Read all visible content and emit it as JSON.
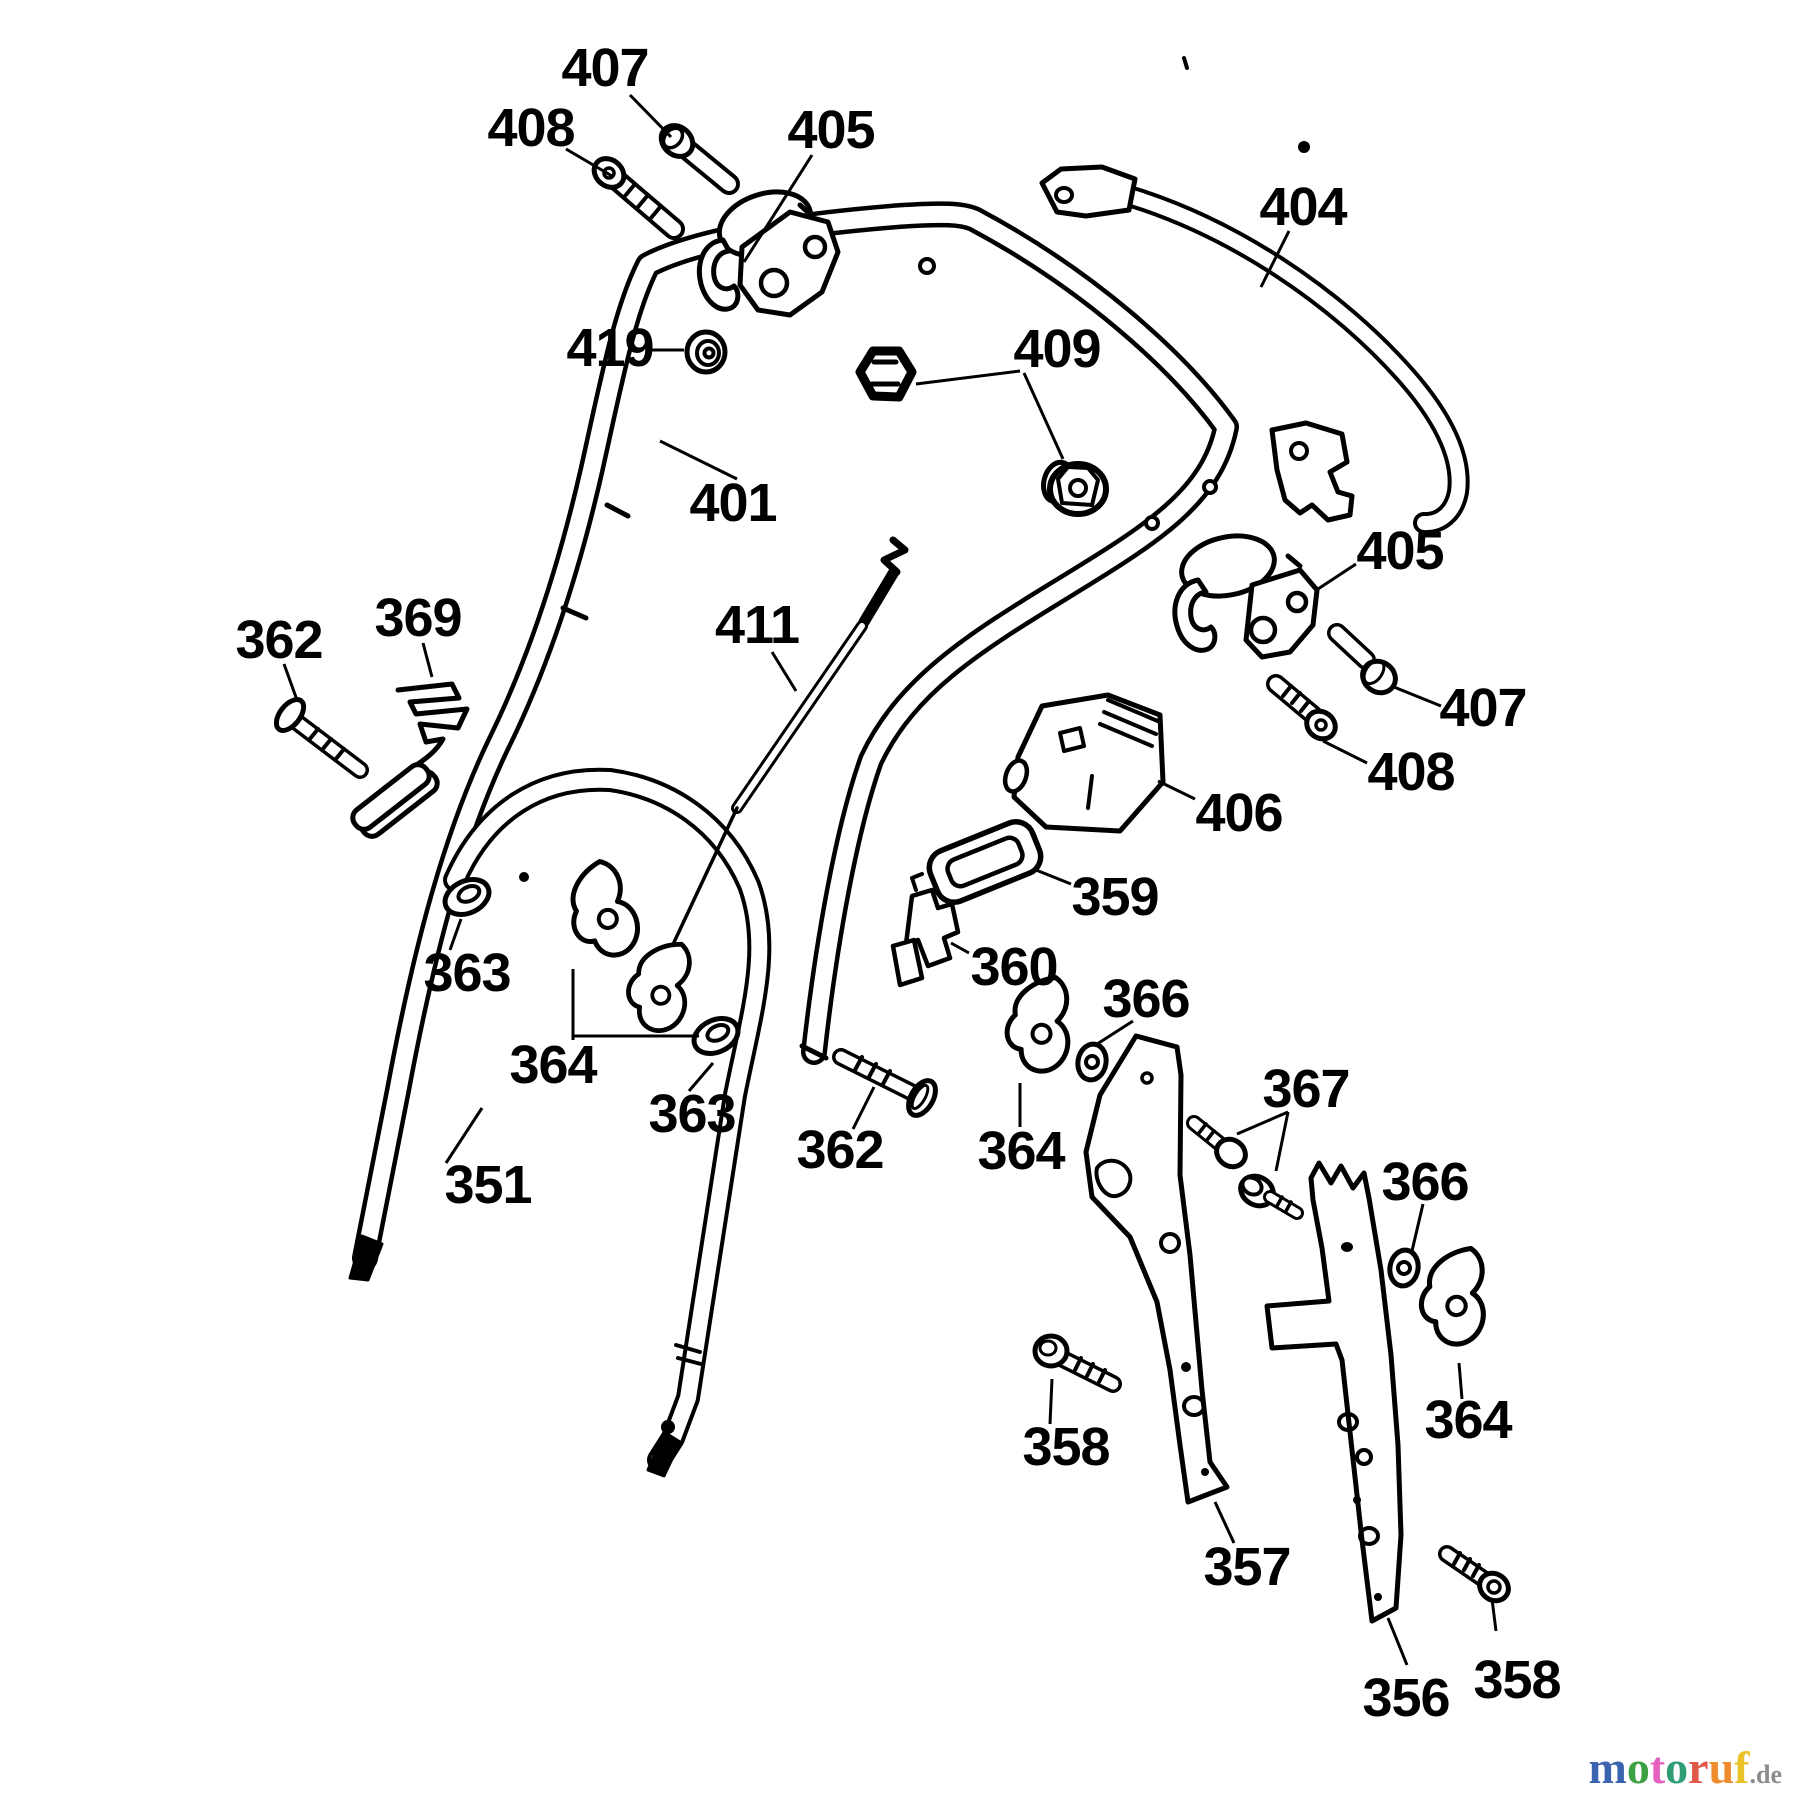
{
  "diagram": {
    "background": "#ffffff",
    "line_color": "#000000",
    "labels": [
      {
        "id": "407-1",
        "text": "407",
        "x": 605,
        "y": 68
      },
      {
        "id": "408-1",
        "text": "408",
        "x": 531,
        "y": 128
      },
      {
        "id": "405-1",
        "text": "405",
        "x": 831,
        "y": 130
      },
      {
        "id": "419",
        "text": "419",
        "x": 610,
        "y": 348
      },
      {
        "id": "404",
        "text": "404",
        "x": 1303,
        "y": 207
      },
      {
        "id": "409",
        "text": "409",
        "x": 1057,
        "y": 349
      },
      {
        "id": "401",
        "text": "401",
        "x": 733,
        "y": 503
      },
      {
        "id": "411",
        "text": "411",
        "x": 757,
        "y": 625
      },
      {
        "id": "362-1",
        "text": "362",
        "x": 279,
        "y": 640
      },
      {
        "id": "369",
        "text": "369",
        "x": 418,
        "y": 618
      },
      {
        "id": "405-2",
        "text": "405",
        "x": 1400,
        "y": 551
      },
      {
        "id": "407-2",
        "text": "407",
        "x": 1483,
        "y": 708
      },
      {
        "id": "408-2",
        "text": "408",
        "x": 1411,
        "y": 772
      },
      {
        "id": "406",
        "text": "406",
        "x": 1239,
        "y": 813
      },
      {
        "id": "359",
        "text": "359",
        "x": 1115,
        "y": 897
      },
      {
        "id": "360",
        "text": "360",
        "x": 1014,
        "y": 967
      },
      {
        "id": "363-1",
        "text": "363",
        "x": 467,
        "y": 973
      },
      {
        "id": "364-1",
        "text": "364",
        "x": 553,
        "y": 1065
      },
      {
        "id": "363-2",
        "text": "363",
        "x": 692,
        "y": 1114
      },
      {
        "id": "362-2",
        "text": "362",
        "x": 840,
        "y": 1150
      },
      {
        "id": "364-2",
        "text": "364",
        "x": 1021,
        "y": 1151
      },
      {
        "id": "366-1",
        "text": "366",
        "x": 1146,
        "y": 999
      },
      {
        "id": "367",
        "text": "367",
        "x": 1306,
        "y": 1089
      },
      {
        "id": "366-2",
        "text": "366",
        "x": 1425,
        "y": 1182
      },
      {
        "id": "364-3",
        "text": "364",
        "x": 1468,
        "y": 1420
      },
      {
        "id": "358-1",
        "text": "358",
        "x": 1066,
        "y": 1447
      },
      {
        "id": "357",
        "text": "357",
        "x": 1247,
        "y": 1567
      },
      {
        "id": "356",
        "text": "356",
        "x": 1406,
        "y": 1698
      },
      {
        "id": "358-2",
        "text": "358",
        "x": 1517,
        "y": 1680
      },
      {
        "id": "351",
        "text": "351",
        "x": 488,
        "y": 1185
      }
    ],
    "leaders": [
      {
        "points": "630,95 671,137"
      },
      {
        "points": "566,149 612,176"
      },
      {
        "points": "812,155 744,262"
      },
      {
        "points": "652,350 684,350"
      },
      {
        "points": "1289,231 1261,287"
      },
      {
        "points": "916,384 1020,371"
      },
      {
        "points": "1024,373 1063,459"
      },
      {
        "points": "737,479 660,441"
      },
      {
        "points": "772,652 796,691"
      },
      {
        "points": "284,664 297,700"
      },
      {
        "points": "423,643 432,677"
      },
      {
        "points": "1356,564 1318,589"
      },
      {
        "points": "1394,687 1441,706"
      },
      {
        "points": "1323,741 1367,763"
      },
      {
        "points": "1195,799 1158,781"
      },
      {
        "points": "1071,884 1036,870"
      },
      {
        "points": "969,953 951,943"
      },
      {
        "points": "450,950 461,919"
      },
      {
        "points": "573,1040 573,969"
      },
      {
        "points": "573,1036 699,1036"
      },
      {
        "points": "689,1091 713,1063"
      },
      {
        "points": "853,1129 874,1087"
      },
      {
        "points": "1020,1127 1020,1083"
      },
      {
        "points": "1133,1021 1094,1046"
      },
      {
        "points": "1288,1112 1237,1134"
      },
      {
        "points": "1288,1112 1276,1171"
      },
      {
        "points": "1423,1204 1412,1251"
      },
      {
        "points": "1462,1399 1459,1363"
      },
      {
        "points": "1050,1424 1052,1379"
      },
      {
        "points": "1215,1502 1234,1543"
      },
      {
        "points": "1388,1618 1407,1665"
      },
      {
        "points": "1496,1631 1492,1599"
      },
      {
        "points": "446,1163 482,1108"
      }
    ]
  },
  "watermark": {
    "letters": [
      {
        "ch": "m",
        "color": "#3b63b0"
      },
      {
        "ch": "o",
        "color": "#3da043"
      },
      {
        "ch": "t",
        "color": "#e560bf"
      },
      {
        "ch": "o",
        "color": "#2f9e74"
      },
      {
        "ch": "r",
        "color": "#e1574a"
      },
      {
        "ch": "u",
        "color": "#ef8d2e"
      },
      {
        "ch": "f",
        "color": "#e9c227"
      }
    ],
    "suffix": ".de",
    "suffix_color": "#8c8c8c"
  }
}
